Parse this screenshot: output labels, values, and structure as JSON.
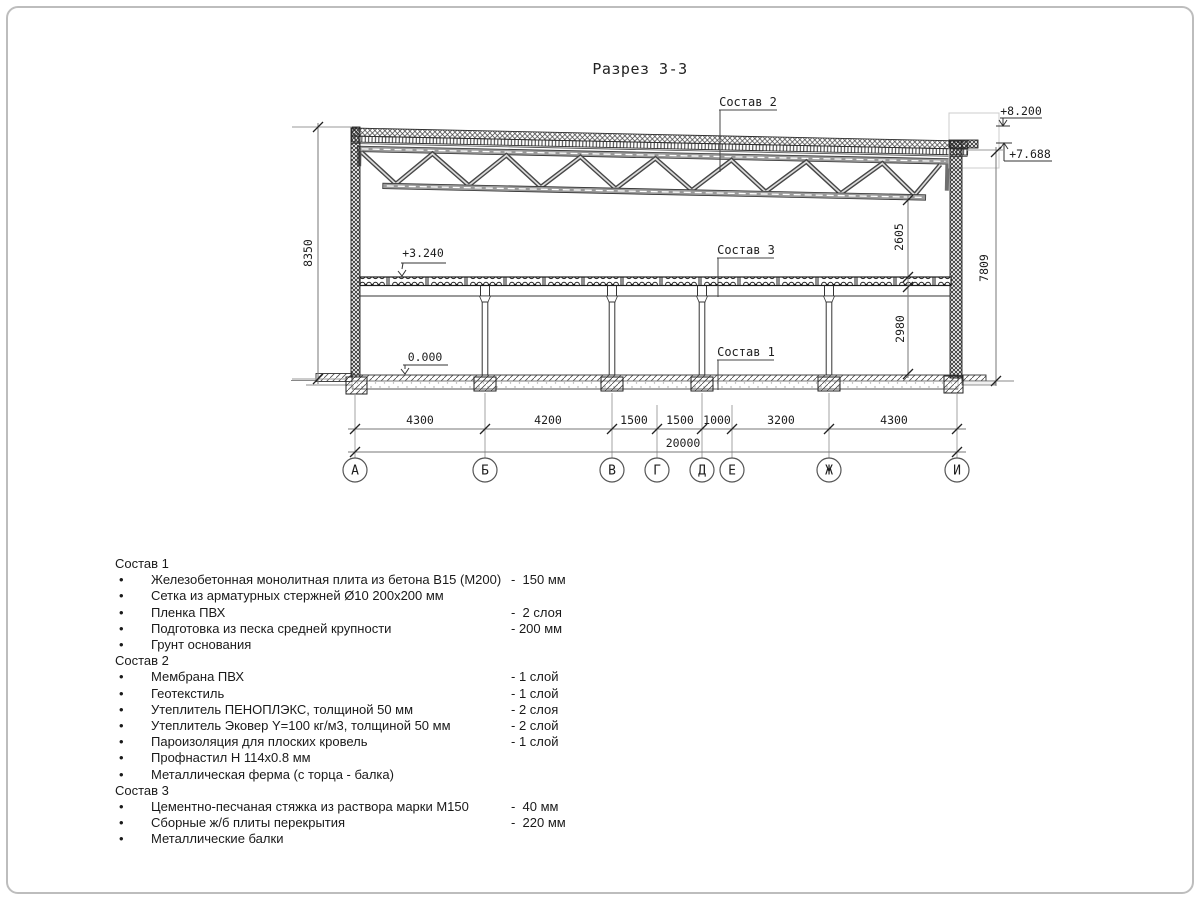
{
  "title": "Разрез 3-3",
  "drawing": {
    "marks": {
      "parapet": "+8.200",
      "roof": "+7.688",
      "slab": "+3.240",
      "floor": "0.000"
    },
    "leaders": {
      "s1": "Состав 1",
      "s2": "Состав 2",
      "s3": "Состав 3"
    },
    "vdims": {
      "left": "8350",
      "upper": "2605",
      "lower": "2980",
      "right": "7809"
    },
    "hdims": {
      "spans": [
        "4300",
        "4200",
        "1500",
        "1500",
        "1000",
        "3200",
        "4300"
      ],
      "total": "20000"
    },
    "axes": [
      "А",
      "Б",
      "В",
      "Г",
      "Д",
      "Е",
      "Ж",
      "И"
    ]
  },
  "legend": {
    "sections": [
      {
        "title": "Состав 1",
        "items": [
          {
            "text": "Железобетонная монолитная плита из бетона В15 (М200)",
            "value": "-  150 мм"
          },
          {
            "text": "Сетка из арматурных стержней Ø10 200х200 мм",
            "value": ""
          },
          {
            "text": "Пленка ПВХ",
            "value": "-  2 слоя"
          },
          {
            "text": "Подготовка из песка средней крупности",
            "value": "- 200 мм"
          },
          {
            "text": "Грунт основания",
            "value": ""
          }
        ]
      },
      {
        "title": "Состав 2",
        "items": [
          {
            "text": "Мембрана ПВХ",
            "value": "- 1 слой"
          },
          {
            "text": "Геотекстиль",
            "value": "- 1 слой"
          },
          {
            "text": "Утеплитель ПЕНОПЛЭКС, толщиной 50 мм",
            "value": "- 2 слоя"
          },
          {
            "text": "Утеплитель Эковер Y=100 кг/м3, толщиной 50 мм",
            "value": "- 2 слой"
          },
          {
            "text": "Пароизоляция для плоских кровель",
            "value": "- 1 слой"
          },
          {
            "text": "Профнастил Н 114х0.8 мм",
            "value": ""
          },
          {
            "text": "Металлическая ферма (с торца - балка)",
            "value": ""
          }
        ]
      },
      {
        "title": "Состав 3",
        "items": [
          {
            "text": "Цементно-песчаная стяжка из раствора марки М150",
            "value": "-  40 мм"
          },
          {
            "text": "Сборные ж/б плиты перекрытия",
            "value": "-  220 мм"
          },
          {
            "text": "Металлические балки",
            "value": ""
          }
        ]
      }
    ]
  }
}
